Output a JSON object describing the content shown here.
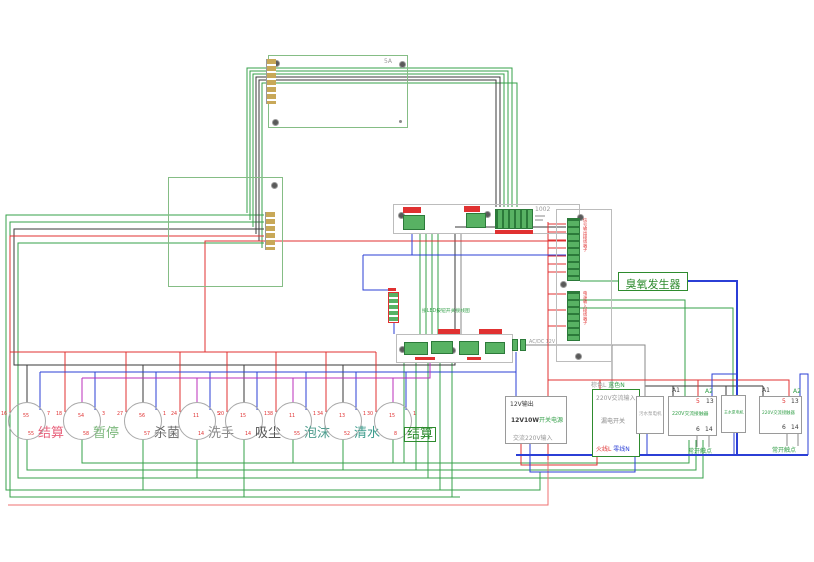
{
  "labels": {
    "ozone": "臭氧发生器",
    "board_main_tag": "1002",
    "board_display_tag": "5A",
    "mid_board_title": "接LED按钮开关接线图",
    "t12v": "AC/DC 12V",
    "strip1_label": "信号输出接线端子",
    "strip2_label": "电源输入接线端子"
  },
  "buttons": [
    {
      "label": "结算",
      "label_color": "#e8627c",
      "pins": {
        "left": "16",
        "center": "55",
        "right": "7",
        "bottom": "55"
      }
    },
    {
      "label": "暂停",
      "label_color": "#7cb87c",
      "pins": {
        "left": "18",
        "center": "54",
        "right": "3",
        "bottom": "58"
      }
    },
    {
      "label": "杀菌",
      "label_color": "#6a6a6a",
      "pins": {
        "left": "27",
        "center": "56",
        "right": "1",
        "bottom": "57"
      }
    },
    {
      "label": "洗手",
      "label_color": "#8a8a8a",
      "pins": {
        "left": "24",
        "center": "11",
        "right": "5",
        "bottom": "14"
      }
    },
    {
      "label": "吸尘",
      "label_color": "#555555",
      "pins": {
        "left": "20",
        "center": "15",
        "right": "1",
        "bottom": "14"
      }
    },
    {
      "label": "泡沫",
      "label_color": "#4e9d8e",
      "pins": {
        "left": "38",
        "center": "11",
        "right": "1",
        "bottom": "55"
      }
    },
    {
      "label": "清水",
      "label_color": "#3f9d8e",
      "pins": {
        "left": "34",
        "center": "13",
        "right": "1",
        "bottom": "52"
      }
    },
    {
      "label": "结算",
      "label_color": "#2e8b2e",
      "boxed": true,
      "pins": {
        "left": "30",
        "center": "15",
        "right": "1",
        "bottom": "8"
      }
    }
  ],
  "psu": {
    "line1": "12V输出",
    "line2_strong": "12V10W",
    "line2_rest": "开关电源",
    "line3": "交流220V输入"
  },
  "breaker": {
    "top_l": "棕色L",
    "top_n": "蓝色N",
    "inside_top": "220V交流输入",
    "name": "漏电开关",
    "bottom_l": "火线L",
    "bottom_n": "零线N"
  },
  "motor1": {
    "name": "污水泵电机"
  },
  "motor2": {
    "name": "主水泵电机"
  },
  "contactor1": {
    "a1": "A1",
    "a2": "A2",
    "t5": "5",
    "t13": "13",
    "t6": "6",
    "t14": "14",
    "name": "220V交流接触器",
    "below": "常开触点"
  },
  "contactor2": {
    "a1": "A1",
    "a2": "A2",
    "t5": "5",
    "t13": "13",
    "t6": "6",
    "t14": "14",
    "name": "220V交流接触器",
    "below": "常开触点"
  },
  "colors": {
    "wire_green": "#35a04a",
    "wire_red": "#e03131",
    "wire_blue": "#2b3fd6",
    "wire_black": "#3a3a3a",
    "wire_magenta": "#bb2fbb",
    "wire_grey": "#8a8a8a",
    "wire_pink": "#ef7070",
    "board_green": "#85bd85",
    "terminal_green": "#58b263",
    "label_red": "#e03131"
  }
}
